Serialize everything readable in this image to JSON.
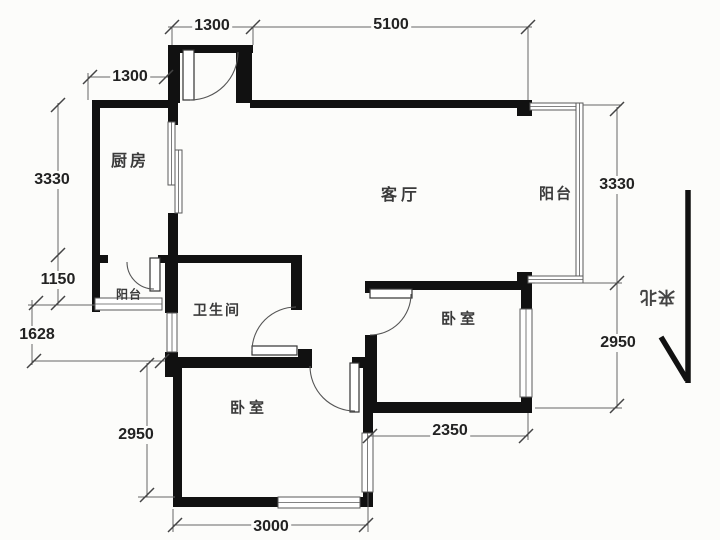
{
  "plan": {
    "type": "apartment-floor-plan",
    "canvas": {
      "width": 720,
      "height": 540
    },
    "colors": {
      "wall": "#111111",
      "thin_line": "#5a5a5a",
      "text": "#333333",
      "background": "#fcfcfa"
    }
  },
  "rooms": [
    {
      "id": "kitchen",
      "label": "厨房",
      "x": 130,
      "y": 159,
      "fs": 16,
      "ls": 3
    },
    {
      "id": "living-room",
      "label": "客厅",
      "x": 401,
      "y": 193,
      "fs": 16,
      "ls": 4
    },
    {
      "id": "balcony-right",
      "label": "阳台",
      "x": 556,
      "y": 193,
      "fs": 15,
      "ls": 2
    },
    {
      "id": "balcony-small",
      "label": "阳台",
      "x": 129,
      "y": 294,
      "fs": 12,
      "ls": 1
    },
    {
      "id": "bathroom",
      "label": "卫生间",
      "x": 217,
      "y": 310,
      "fs": 14,
      "ls": 2
    },
    {
      "id": "bedroom-right",
      "label": "卧室",
      "x": 460,
      "y": 318,
      "fs": 15,
      "ls": 4
    },
    {
      "id": "bedroom-bottom",
      "label": "卧室",
      "x": 249,
      "y": 407,
      "fs": 15,
      "ls": 4
    }
  ],
  "dimension_labels": [
    {
      "text": "1300",
      "x": 212,
      "y": 26,
      "fs": 16
    },
    {
      "text": "5100",
      "x": 391,
      "y": 25,
      "fs": 16
    },
    {
      "text": "1300",
      "x": 130,
      "y": 77,
      "fs": 16
    },
    {
      "text": "3330",
      "x": 52,
      "y": 180,
      "fs": 16
    },
    {
      "text": "1150",
      "x": 58,
      "y": 280,
      "fs": 16
    },
    {
      "text": "1628",
      "x": 37,
      "y": 335,
      "fs": 16
    },
    {
      "text": "2950",
      "x": 136,
      "y": 435,
      "fs": 16
    },
    {
      "text": "3000",
      "x": 271,
      "y": 527,
      "fs": 16
    },
    {
      "text": "2350",
      "x": 450,
      "y": 431,
      "fs": 16
    },
    {
      "text": "3330",
      "x": 617,
      "y": 185,
      "fs": 16
    },
    {
      "text": "2950",
      "x": 618,
      "y": 343,
      "fs": 16
    }
  ],
  "north": {
    "label": "来北",
    "x": 657,
    "y": 299,
    "fs": 17
  },
  "geometry": {
    "walls": [
      {
        "x": 168,
        "y": 45,
        "w": 85,
        "h": 8
      },
      {
        "x": 168,
        "y": 45,
        "w": 12,
        "h": 58
      },
      {
        "x": 236,
        "y": 45,
        "w": 16,
        "h": 58
      },
      {
        "x": 92,
        "y": 100,
        "w": 78,
        "h": 8
      },
      {
        "x": 250,
        "y": 100,
        "w": 282,
        "h": 8
      },
      {
        "x": 517,
        "y": 100,
        "w": 15,
        "h": 16
      },
      {
        "x": 92,
        "y": 100,
        "w": 8,
        "h": 212
      },
      {
        "x": 168,
        "y": 103,
        "w": 10,
        "h": 22
      },
      {
        "x": 168,
        "y": 213,
        "w": 10,
        "h": 50
      },
      {
        "x": 92,
        "y": 255,
        "w": 16,
        "h": 8
      },
      {
        "x": 158,
        "y": 255,
        "w": 144,
        "h": 8
      },
      {
        "x": 165,
        "y": 263,
        "w": 13,
        "h": 50
      },
      {
        "x": 165,
        "y": 352,
        "w": 13,
        "h": 25
      },
      {
        "x": 291,
        "y": 255,
        "w": 11,
        "h": 55
      },
      {
        "x": 165,
        "y": 357,
        "w": 147,
        "h": 11
      },
      {
        "x": 298,
        "y": 349,
        "w": 14,
        "h": 9
      },
      {
        "x": 352,
        "y": 357,
        "w": 25,
        "h": 11
      },
      {
        "x": 173,
        "y": 357,
        "w": 9,
        "h": 150
      },
      {
        "x": 173,
        "y": 497,
        "w": 107,
        "h": 10
      },
      {
        "x": 358,
        "y": 497,
        "w": 12,
        "h": 10
      },
      {
        "x": 363,
        "y": 368,
        "w": 10,
        "h": 65
      },
      {
        "x": 363,
        "y": 492,
        "w": 10,
        "h": 15
      },
      {
        "x": 365,
        "y": 281,
        "w": 12,
        "h": 12
      },
      {
        "x": 365,
        "y": 335,
        "w": 12,
        "h": 78
      },
      {
        "x": 365,
        "y": 281,
        "w": 165,
        "h": 9
      },
      {
        "x": 521,
        "y": 281,
        "w": 11,
        "h": 28
      },
      {
        "x": 521,
        "y": 397,
        "w": 11,
        "h": 16
      },
      {
        "x": 517,
        "y": 272,
        "w": 15,
        "h": 13
      },
      {
        "x": 363,
        "y": 402,
        "w": 168,
        "h": 11
      }
    ],
    "windows": [
      {
        "x": 168,
        "y": 122,
        "w": 7,
        "h": 63,
        "o": "v"
      },
      {
        "x": 175,
        "y": 150,
        "w": 7,
        "h": 63,
        "o": "v"
      },
      {
        "x": 95,
        "y": 298,
        "w": 67,
        "h": 12,
        "o": "h"
      },
      {
        "x": 167,
        "y": 313,
        "w": 10,
        "h": 39,
        "o": "v"
      },
      {
        "x": 278,
        "y": 497,
        "w": 82,
        "h": 11,
        "o": "h"
      },
      {
        "x": 362,
        "y": 433,
        "w": 11,
        "h": 59,
        "o": "v"
      },
      {
        "x": 520,
        "y": 309,
        "w": 12,
        "h": 88,
        "o": "v"
      },
      {
        "x": 530,
        "y": 103,
        "w": 53,
        "h": 7,
        "o": "h"
      },
      {
        "x": 576,
        "y": 103,
        "w": 7,
        "h": 180,
        "o": "v"
      },
      {
        "x": 528,
        "y": 276,
        "w": 55,
        "h": 7,
        "o": "h"
      }
    ],
    "door_leaves": [
      {
        "x": 183,
        "y": 50,
        "w": 11,
        "h": 50
      },
      {
        "x": 150,
        "y": 258,
        "w": 10,
        "h": 33
      },
      {
        "x": 252,
        "y": 346,
        "w": 45,
        "h": 9
      },
      {
        "x": 350,
        "y": 363,
        "w": 9,
        "h": 49
      },
      {
        "x": 370,
        "y": 289,
        "w": 42,
        "h": 9
      }
    ],
    "door_arcs": [
      {
        "x1": 238,
        "y1": 52,
        "r": 48,
        "x2": 190,
        "y2": 100,
        "sweep": 1
      },
      {
        "x1": 127,
        "y1": 262,
        "r": 27,
        "x2": 154,
        "y2": 289,
        "sweep": 0
      },
      {
        "x1": 252,
        "y1": 351,
        "r": 44,
        "x2": 296,
        "y2": 307,
        "sweep": 1
      },
      {
        "x1": 310,
        "y1": 366,
        "r": 45,
        "x2": 355,
        "y2": 411,
        "sweep": 0
      },
      {
        "x1": 411,
        "y1": 294,
        "r": 41,
        "x2": 370,
        "y2": 335,
        "sweep": 1
      }
    ],
    "dim_lines": [
      {
        "x1": 168,
        "y1": 27,
        "x2": 532,
        "y2": 27
      },
      {
        "x1": 172,
        "y1": 27,
        "x2": 172,
        "y2": 45
      },
      {
        "x1": 253,
        "y1": 27,
        "x2": 253,
        "y2": 45
      },
      {
        "x1": 528,
        "y1": 27,
        "x2": 528,
        "y2": 100
      },
      {
        "x1": 88,
        "y1": 77,
        "x2": 168,
        "y2": 77
      },
      {
        "x1": 88,
        "y1": 73,
        "x2": 88,
        "y2": 100
      },
      {
        "x1": 58,
        "y1": 103,
        "x2": 58,
        "y2": 305
      },
      {
        "x1": 28,
        "y1": 305,
        "x2": 95,
        "y2": 305
      },
      {
        "x1": 32,
        "y1": 361,
        "x2": 165,
        "y2": 361
      },
      {
        "x1": 32,
        "y1": 300,
        "x2": 32,
        "y2": 365
      },
      {
        "x1": 147,
        "y1": 363,
        "x2": 147,
        "y2": 497
      },
      {
        "x1": 138,
        "y1": 497,
        "x2": 175,
        "y2": 497
      },
      {
        "x1": 173,
        "y1": 525,
        "x2": 368,
        "y2": 525
      },
      {
        "x1": 173,
        "y1": 509,
        "x2": 173,
        "y2": 532
      },
      {
        "x1": 368,
        "y1": 493,
        "x2": 368,
        "y2": 532
      },
      {
        "x1": 368,
        "y1": 436,
        "x2": 528,
        "y2": 436
      },
      {
        "x1": 528,
        "y1": 413,
        "x2": 528,
        "y2": 440
      },
      {
        "x1": 617,
        "y1": 107,
        "x2": 617,
        "y2": 408
      },
      {
        "x1": 583,
        "y1": 105,
        "x2": 622,
        "y2": 105
      },
      {
        "x1": 535,
        "y1": 283,
        "x2": 622,
        "y2": 283
      },
      {
        "x1": 535,
        "y1": 408,
        "x2": 622,
        "y2": 408
      }
    ],
    "ticks": [
      {
        "x": 172,
        "y": 27
      },
      {
        "x": 253,
        "y": 27
      },
      {
        "x": 528,
        "y": 27
      },
      {
        "x": 90,
        "y": 77
      },
      {
        "x": 166,
        "y": 77
      },
      {
        "x": 58,
        "y": 105
      },
      {
        "x": 58,
        "y": 255
      },
      {
        "x": 58,
        "y": 303
      },
      {
        "x": 36,
        "y": 303
      },
      {
        "x": 34,
        "y": 361
      },
      {
        "x": 162,
        "y": 361
      },
      {
        "x": 147,
        "y": 365
      },
      {
        "x": 147,
        "y": 495
      },
      {
        "x": 175,
        "y": 525
      },
      {
        "x": 366,
        "y": 525
      },
      {
        "x": 370,
        "y": 436
      },
      {
        "x": 526,
        "y": 436
      },
      {
        "x": 617,
        "y": 109
      },
      {
        "x": 617,
        "y": 283
      },
      {
        "x": 617,
        "y": 406
      }
    ],
    "north_lines": [
      {
        "x1": 688,
        "y1": 190,
        "x2": 688,
        "y2": 383
      },
      {
        "x1": 661,
        "y1": 337,
        "x2": 687,
        "y2": 380
      }
    ]
  }
}
